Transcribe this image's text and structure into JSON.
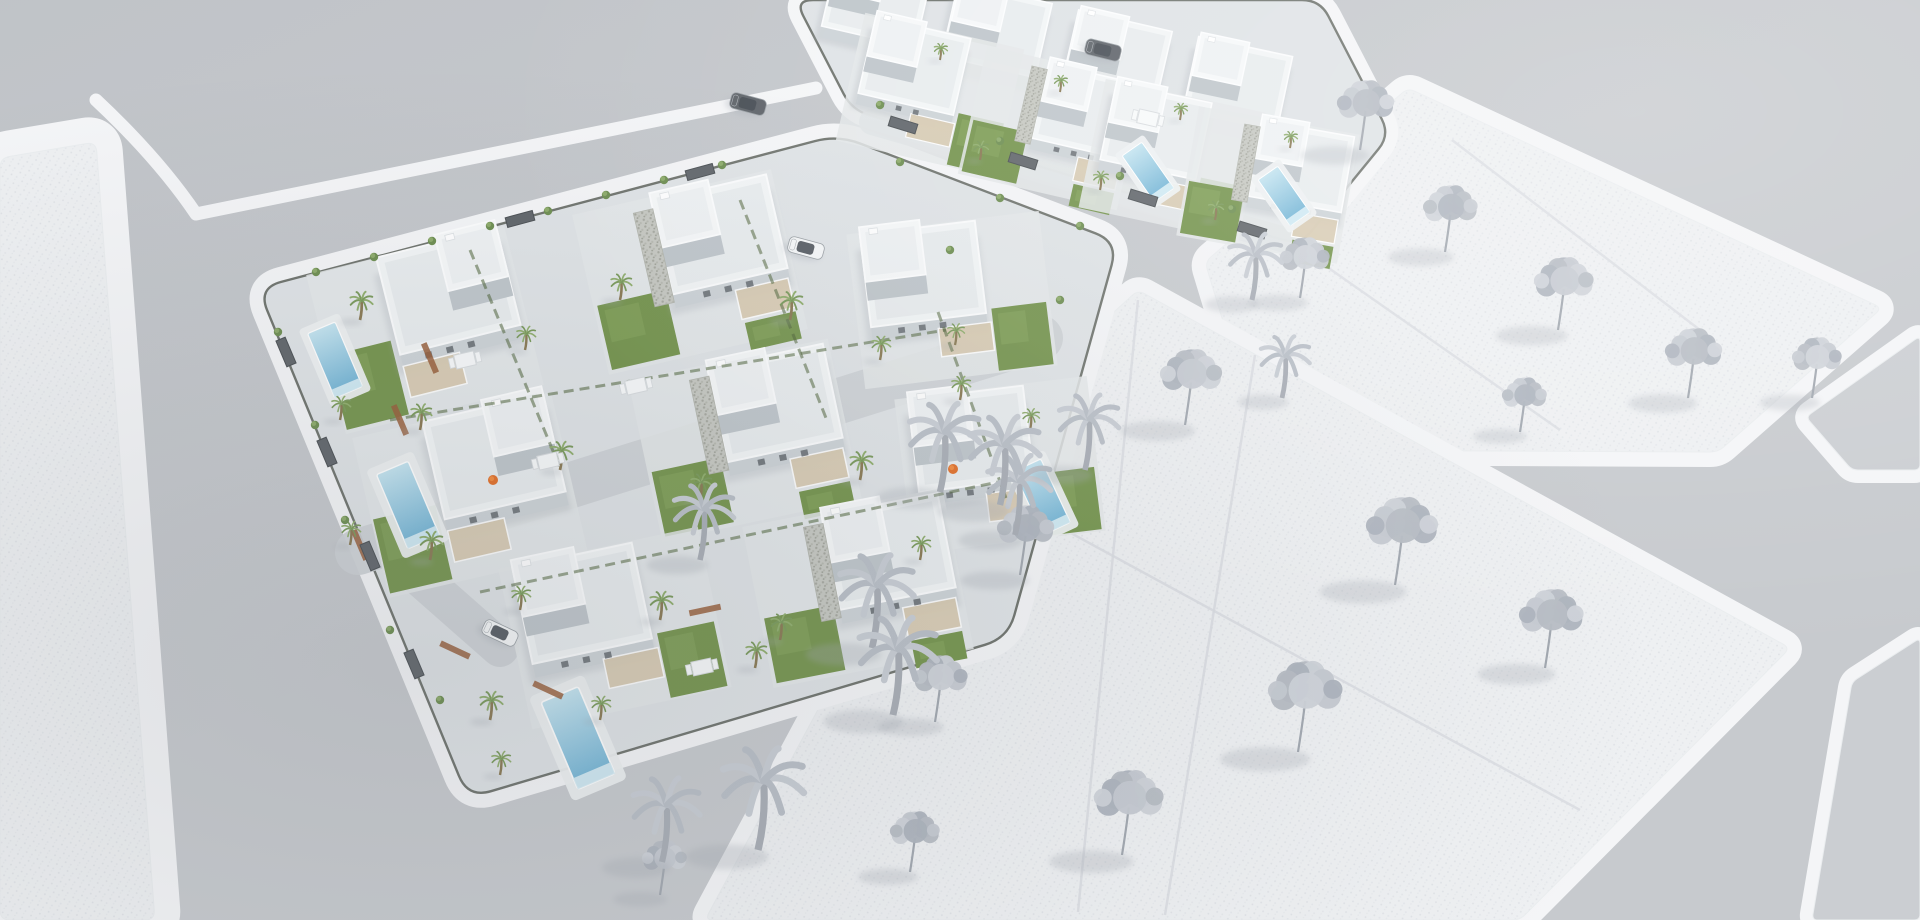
{
  "scene_title": "aerial-3d-render-villa-development",
  "palette": {
    "background": "#c7cacE",
    "road_shade_dark": "#aeb3ba",
    "road_shade_light": "#d3d6da",
    "sidewalk": "#f4f5f7",
    "plot_fill": "#eef0f2",
    "plot_dot_a": "#dfe2e6",
    "plot_dot_b": "#e5e8ec",
    "plot_line": "#d9dce1",
    "block_paving": "#dfe3e6",
    "villa_base": "#e4e7e9",
    "wall_shadow": "#cdd3d7",
    "wall_deep": "#bfc6cb",
    "roof_light": "#f2f5f6",
    "roof_field": "#e8ecee",
    "roof_top": "#f6f8f9",
    "stone_bg": "#c6c8c2",
    "stone_dot1": "#a6a8a0",
    "stone_dot2": "#b6b8b0",
    "pergola_wood": "#d8cab0",
    "lawn": "#76954f",
    "lawn_light": "#88a75f",
    "hedge": "#4e6339",
    "fence_dark": "#5a5f58",
    "gate_panel": "#62676c",
    "planter": "#995f3b",
    "pool_deck": "#edf0f1",
    "pool_shallow": "#c4e4f0",
    "pool_deep": "#6fb2d4",
    "pool_steps": "#d9eef6",
    "gray_tree_1": "#c6cad1",
    "gray_tree_2": "#b7bcc4",
    "gray_tree_3": "#ced2d8",
    "gray_tree_4": "#aeb4bd",
    "gray_trunk": "#a2a8b0",
    "tree_shadow": "#a6abb3",
    "green_palm": "#7a9a5c",
    "green_palm_light": "#90ae6e",
    "bush_green": "#6f8f53",
    "car_white_body": "#f5f7f8",
    "car_dark_body": "#5f646a",
    "car_glass": "#474d54",
    "accent_orange": "#e2702a",
    "accent_orange_light": "#f28b3e",
    "furniture_white": "#f7f9fa",
    "furniture_edge": "#d8dcdf"
  },
  "scene": {
    "width": 1920,
    "height": 920,
    "parcels": [
      {
        "id": "plot-left-textured",
        "kind": "textured",
        "round": 10,
        "sidewalk": 52,
        "points": [
          [
            0,
            158
          ],
          [
            96,
            142
          ],
          [
            155,
            920
          ],
          [
            0,
            920
          ]
        ]
      },
      {
        "id": "plot-upper-right-textured",
        "kind": "textured",
        "round": 8,
        "sidewalk": 30,
        "points": [
          [
            1205,
            262
          ],
          [
            1408,
            88
          ],
          [
            1882,
            308
          ],
          [
            1718,
            452
          ],
          [
            1262,
            450
          ]
        ]
      },
      {
        "id": "plot-lower-right-textured",
        "kind": "textured",
        "round": 8,
        "sidewalk": 30,
        "points": [
          [
            1138,
            290
          ],
          [
            1790,
            648
          ],
          [
            1520,
            920
          ],
          [
            705,
            920
          ],
          [
            952,
            460
          ]
        ]
      },
      {
        "id": "parcel-far-right-top",
        "kind": "plain",
        "round": 6,
        "sidewalk": 26,
        "points": [
          [
            1806,
            417
          ],
          [
            1920,
            336
          ],
          [
            1920,
            470
          ],
          [
            1852,
            470
          ]
        ]
      },
      {
        "id": "parcel-far-right-bottom",
        "kind": "plain",
        "round": 6,
        "sidewalk": 26,
        "points": [
          [
            1852,
            682
          ],
          [
            1920,
            638
          ],
          [
            1920,
            920
          ],
          [
            1812,
            920
          ]
        ]
      },
      {
        "id": "villa-block-front",
        "kind": "block",
        "round": 24,
        "sidewalk": 30,
        "points": [
          [
            258,
            288
          ],
          [
            838,
            135
          ],
          [
            1118,
            242
          ],
          [
            1008,
            638
          ],
          [
            468,
            798
          ]
        ]
      },
      {
        "id": "villa-block-rear",
        "kind": "block",
        "round": 18,
        "sidewalk": 26,
        "points": [
          [
            795,
            0
          ],
          [
            852,
            110
          ],
          [
            1300,
            245
          ],
          [
            1390,
            135
          ],
          [
            1320,
            0
          ]
        ]
      }
    ],
    "sidewalk_paths": [
      {
        "id": "junction-north-sidewalk",
        "d": "M 96,100 Q 158,158 196,214 L 816,88"
      }
    ],
    "division_lines": [
      {
        "from": [
          1452,
          140
        ],
        "to": [
          1700,
          330
        ]
      },
      {
        "from": [
          1310,
          255
        ],
        "to": [
          1560,
          430
        ]
      },
      {
        "from": [
          1138,
          300
        ],
        "to": [
          1078,
          912
        ]
      },
      {
        "from": [
          955,
          470
        ],
        "to": [
          1580,
          810
        ]
      },
      {
        "from": [
          1255,
          355
        ],
        "to": [
          1165,
          915
        ]
      }
    ],
    "driveways": [
      {
        "from": [
          358,
          552
        ],
        "to": [
          1040,
          338
        ],
        "w": 46
      },
      {
        "from": [
          400,
          560
        ],
        "to": [
          500,
          648
        ],
        "w": 38
      },
      {
        "from": [
          872,
          122
        ],
        "to": [
          1292,
          242
        ],
        "w": 26
      }
    ],
    "villa_variants": {
      "A": {
        "house": [
          -30,
          -74,
          124,
          100
        ],
        "vol2": [
          32,
          -74,
          62,
          58
        ],
        "stone": null,
        "pergola": [
          -30,
          30,
          58,
          32
        ],
        "lawns": [
          [
            -100,
            2,
            64,
            76
          ]
        ],
        "windows": [
          [
            -6,
            22
          ],
          [
            16,
            22
          ],
          [
            38,
            22
          ]
        ]
      },
      "B": {
        "house": [
          -22,
          -70,
          118,
          96
        ],
        "vol2": [
          -22,
          -70,
          60,
          56
        ],
        "stone": [
          -42,
          -70,
          20,
          96
        ],
        "pergola": [
          40,
          28,
          54,
          30
        ],
        "lawns": [
          [
            -98,
            12,
            70,
            66
          ],
          [
            42,
            62,
            52,
            28
          ]
        ],
        "windows": [
          [
            8,
            22
          ],
          [
            30,
            22
          ],
          [
            52,
            22
          ]
        ]
      },
      "C": {
        "house": [
          -88,
          -72,
          122,
          98
        ],
        "vol2": [
          -88,
          -72,
          64,
          58
        ],
        "stone": null,
        "pergola": [
          -18,
          28,
          56,
          30
        ],
        "lawns": [
          [
            40,
            14,
            58,
            66
          ]
        ],
        "windows": [
          [
            -60,
            22
          ],
          [
            -38,
            22
          ],
          [
            -16,
            22
          ]
        ]
      },
      "R": {
        "house": [
          -60,
          -50,
          120,
          95
        ],
        "vol2": [
          -58,
          -48,
          62,
          55
        ],
        "stone": null,
        "pergola": null,
        "lawns": [],
        "windows": []
      }
    },
    "villas": [
      {
        "x": 425,
        "y": 330,
        "rot": -14,
        "variant": "A",
        "s": 1
      },
      {
        "x": 690,
        "y": 272,
        "rot": -13,
        "variant": "B",
        "s": 1
      },
      {
        "x": 952,
        "y": 300,
        "rot": -7,
        "variant": "C",
        "s": 0.95
      },
      {
        "x": 470,
        "y": 495,
        "rot": -13,
        "variant": "A",
        "s": 1
      },
      {
        "x": 745,
        "y": 440,
        "rot": -12,
        "variant": "B",
        "s": 1
      },
      {
        "x": 1000,
        "y": 465,
        "rot": -7,
        "variant": "C",
        "s": 0.95
      },
      {
        "x": 615,
        "y": 628,
        "rot": -12,
        "variant": "C",
        "s": 1
      },
      {
        "x": 858,
        "y": 588,
        "rot": -11,
        "variant": "B",
        "s": 1
      },
      {
        "x": 930,
        "y": 95,
        "rot": 13,
        "variant": "C",
        "s": 0.8
      },
      {
        "x": 1052,
        "y": 128,
        "rot": 13,
        "variant": "B",
        "s": 0.8
      },
      {
        "x": 1172,
        "y": 160,
        "rot": 12,
        "variant": "C",
        "s": 0.8
      },
      {
        "x": 1268,
        "y": 185,
        "rot": 10,
        "variant": "B",
        "s": 0.8
      },
      {
        "x": 875,
        "y": 8,
        "rot": 13,
        "variant": "R",
        "s": 0.8
      },
      {
        "x": 995,
        "y": 38,
        "rot": 13,
        "variant": "R",
        "s": 0.8
      },
      {
        "x": 1115,
        "y": 66,
        "rot": 13,
        "variant": "R",
        "s": 0.8
      },
      {
        "x": 1236,
        "y": 92,
        "rot": 12,
        "variant": "R",
        "s": 0.8
      }
    ],
    "pools": [
      {
        "x": 335,
        "y": 360,
        "rot": 67,
        "s": 1
      },
      {
        "x": 408,
        "y": 505,
        "rot": 67,
        "s": 1.15
      },
      {
        "x": 578,
        "y": 738,
        "rot": 67,
        "s": 1.35
      },
      {
        "x": 1042,
        "y": 497,
        "rot": 65,
        "s": 1
      },
      {
        "x": 1148,
        "y": 172,
        "rot": 55,
        "s": 0.8
      },
      {
        "x": 1284,
        "y": 196,
        "rot": 55,
        "s": 0.8
      }
    ],
    "gray_trees": [
      {
        "x": 1360,
        "y": 150,
        "s": 46
      },
      {
        "x": 1300,
        "y": 298,
        "s": 40
      },
      {
        "x": 1445,
        "y": 252,
        "s": 44
      },
      {
        "x": 1558,
        "y": 330,
        "s": 48
      },
      {
        "x": 1688,
        "y": 398,
        "s": 46
      },
      {
        "x": 1812,
        "y": 398,
        "s": 40
      },
      {
        "x": 1520,
        "y": 432,
        "s": 36
      },
      {
        "x": 1185,
        "y": 425,
        "s": 50
      },
      {
        "x": 1395,
        "y": 585,
        "s": 58
      },
      {
        "x": 1298,
        "y": 752,
        "s": 60
      },
      {
        "x": 1020,
        "y": 575,
        "s": 46
      },
      {
        "x": 1122,
        "y": 855,
        "s": 56
      },
      {
        "x": 1545,
        "y": 668,
        "s": 52
      },
      {
        "x": 935,
        "y": 722,
        "s": 44
      },
      {
        "x": 910,
        "y": 872,
        "s": 40
      },
      {
        "x": 660,
        "y": 895,
        "s": 36
      }
    ],
    "gray_palms": [
      {
        "x": 940,
        "y": 492,
        "s": 40
      },
      {
        "x": 1015,
        "y": 535,
        "s": 36
      },
      {
        "x": 872,
        "y": 648,
        "s": 42
      },
      {
        "x": 758,
        "y": 850,
        "s": 46
      },
      {
        "x": 893,
        "y": 715,
        "s": 44
      },
      {
        "x": 700,
        "y": 560,
        "s": 34
      },
      {
        "x": 1000,
        "y": 505,
        "s": 40
      },
      {
        "x": 1085,
        "y": 470,
        "s": 34
      },
      {
        "x": 1252,
        "y": 300,
        "s": 30
      },
      {
        "x": 1282,
        "y": 398,
        "s": 28
      },
      {
        "x": 662,
        "y": 862,
        "s": 38
      }
    ],
    "green_palms": [
      {
        "x": 360,
        "y": 320,
        "s": 12
      },
      {
        "x": 525,
        "y": 350,
        "s": 10
      },
      {
        "x": 620,
        "y": 300,
        "s": 11
      },
      {
        "x": 790,
        "y": 320,
        "s": 12
      },
      {
        "x": 880,
        "y": 360,
        "s": 10
      },
      {
        "x": 420,
        "y": 430,
        "s": 11
      },
      {
        "x": 560,
        "y": 470,
        "s": 12
      },
      {
        "x": 700,
        "y": 500,
        "s": 11
      },
      {
        "x": 860,
        "y": 480,
        "s": 12
      },
      {
        "x": 960,
        "y": 400,
        "s": 10
      },
      {
        "x": 430,
        "y": 560,
        "s": 12
      },
      {
        "x": 520,
        "y": 610,
        "s": 10
      },
      {
        "x": 660,
        "y": 620,
        "s": 12
      },
      {
        "x": 780,
        "y": 640,
        "s": 11
      },
      {
        "x": 920,
        "y": 560,
        "s": 10
      },
      {
        "x": 490,
        "y": 720,
        "s": 12
      },
      {
        "x": 600,
        "y": 720,
        "s": 10
      },
      {
        "x": 340,
        "y": 420,
        "s": 10
      },
      {
        "x": 350,
        "y": 545,
        "s": 10
      },
      {
        "x": 500,
        "y": 775,
        "s": 10
      },
      {
        "x": 955,
        "y": 345,
        "s": 9
      },
      {
        "x": 1030,
        "y": 430,
        "s": 9
      },
      {
        "x": 755,
        "y": 668,
        "s": 11
      },
      {
        "x": 980,
        "y": 160,
        "s": 8
      },
      {
        "x": 1100,
        "y": 190,
        "s": 8
      },
      {
        "x": 1215,
        "y": 220,
        "s": 8
      },
      {
        "x": 940,
        "y": 60,
        "s": 7
      },
      {
        "x": 1060,
        "y": 92,
        "s": 7
      },
      {
        "x": 1180,
        "y": 120,
        "s": 7
      },
      {
        "x": 1290,
        "y": 148,
        "s": 7
      }
    ],
    "bushes": [
      {
        "x": 316,
        "y": 272
      },
      {
        "x": 374,
        "y": 257
      },
      {
        "x": 432,
        "y": 241
      },
      {
        "x": 490,
        "y": 226
      },
      {
        "x": 548,
        "y": 211
      },
      {
        "x": 606,
        "y": 195
      },
      {
        "x": 664,
        "y": 180
      },
      {
        "x": 722,
        "y": 165
      },
      {
        "x": 900,
        "y": 162
      },
      {
        "x": 1000,
        "y": 198
      },
      {
        "x": 1080,
        "y": 226
      },
      {
        "x": 880,
        "y": 105
      },
      {
        "x": 1000,
        "y": 141
      },
      {
        "x": 1120,
        "y": 176
      },
      {
        "x": 1232,
        "y": 209
      },
      {
        "x": 278,
        "y": 332
      },
      {
        "x": 315,
        "y": 425
      },
      {
        "x": 345,
        "y": 520
      },
      {
        "x": 390,
        "y": 630
      },
      {
        "x": 440,
        "y": 700
      },
      {
        "x": 950,
        "y": 250
      },
      {
        "x": 1060,
        "y": 300
      }
    ],
    "hedges": [
      {
        "from": [
          470,
          250
        ],
        "to": [
          560,
          468
        ]
      },
      {
        "from": [
          740,
          200
        ],
        "to": [
          826,
          418
        ]
      },
      {
        "from": [
          938,
          312
        ],
        "to": [
          1006,
          498
        ]
      },
      {
        "from": [
          390,
          420
        ],
        "to": [
          946,
          330
        ]
      },
      {
        "from": [
          480,
          592
        ],
        "to": [
          998,
          482
        ]
      }
    ],
    "planters": [
      {
        "x": 455,
        "y": 650,
        "rot": 25
      },
      {
        "x": 548,
        "y": 690,
        "rot": 25
      },
      {
        "x": 400,
        "y": 420,
        "rot": 67
      },
      {
        "x": 360,
        "y": 545,
        "rot": 67
      },
      {
        "x": 705,
        "y": 610,
        "rot": -12
      },
      {
        "x": 430,
        "y": 358,
        "rot": 67
      }
    ],
    "gates": [
      {
        "x": 286,
        "y": 352,
        "rot": 67
      },
      {
        "x": 327,
        "y": 452,
        "rot": 67
      },
      {
        "x": 370,
        "y": 556,
        "rot": 67
      },
      {
        "x": 414,
        "y": 664,
        "rot": 67
      },
      {
        "x": 520,
        "y": 219,
        "rot": -15
      },
      {
        "x": 700,
        "y": 172,
        "rot": -15
      },
      {
        "x": 903,
        "y": 125,
        "rot": 17
      },
      {
        "x": 1023,
        "y": 161,
        "rot": 17
      },
      {
        "x": 1143,
        "y": 198,
        "rot": 17
      },
      {
        "x": 1252,
        "y": 230,
        "rot": 17
      }
    ],
    "cars": [
      {
        "x": 500,
        "y": 633,
        "rot": 25,
        "color": "white"
      },
      {
        "x": 748,
        "y": 104,
        "rot": 15,
        "color": "dark"
      },
      {
        "x": 806,
        "y": 248,
        "rot": 15,
        "color": "white"
      },
      {
        "x": 1103,
        "y": 50,
        "rot": 14,
        "color": "dark"
      }
    ],
    "furniture": [
      {
        "x": 465,
        "y": 360,
        "rot": -13
      },
      {
        "x": 548,
        "y": 461,
        "rot": -13
      },
      {
        "x": 702,
        "y": 667,
        "rot": -12
      },
      {
        "x": 636,
        "y": 386,
        "rot": -13
      },
      {
        "x": 1148,
        "y": 118,
        "rot": 13
      }
    ],
    "accents": [
      {
        "x": 493,
        "y": 480
      },
      {
        "x": 953,
        "y": 469
      }
    ]
  }
}
